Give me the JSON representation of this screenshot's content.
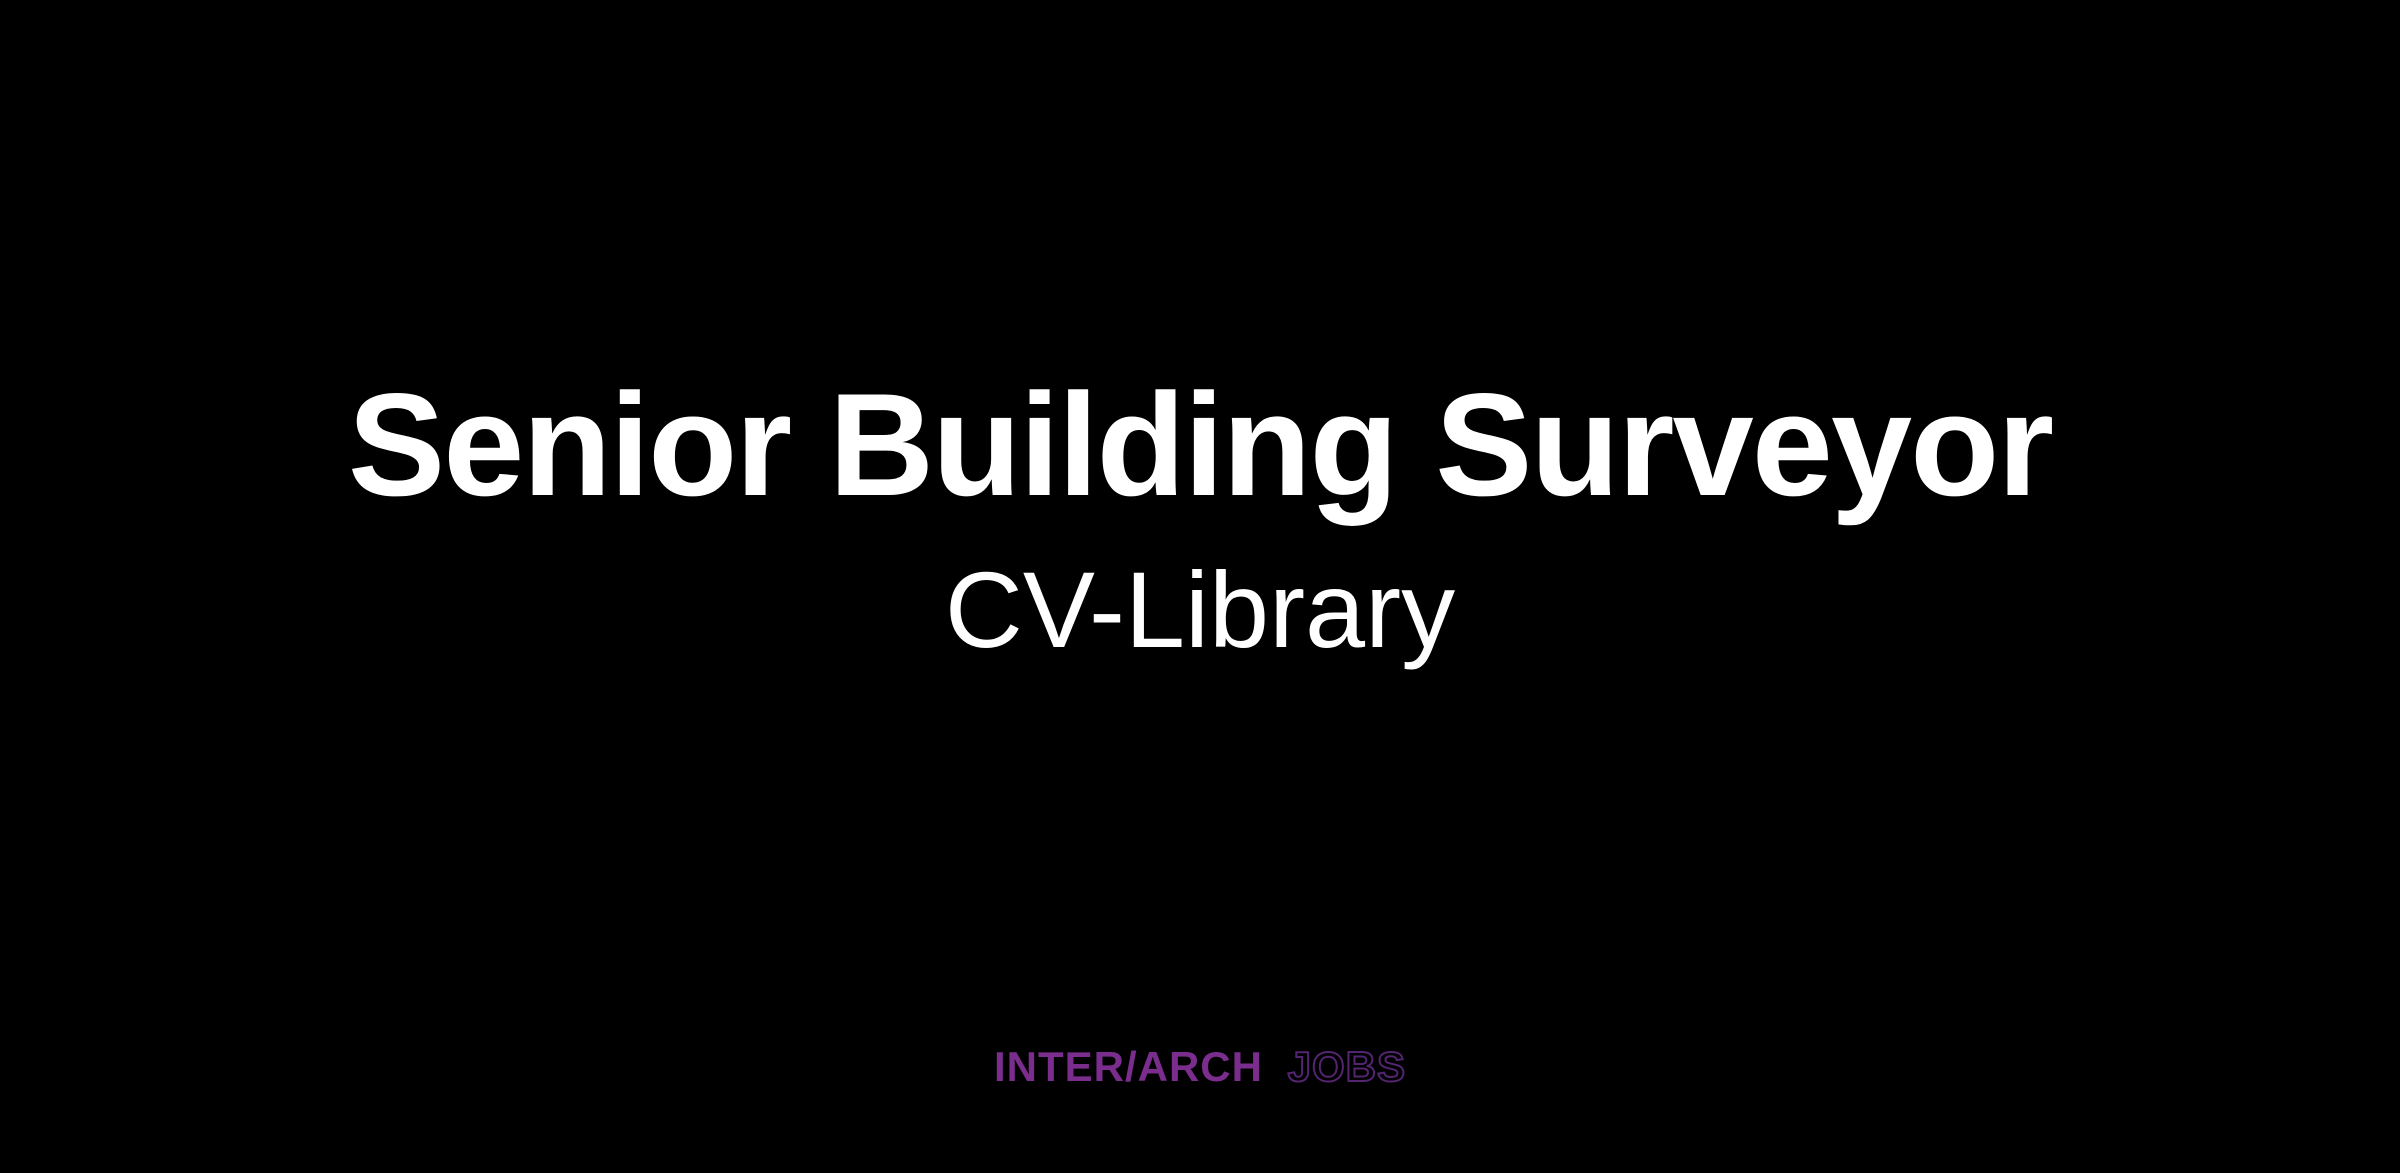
{
  "card": {
    "background_color": "#000000",
    "title": "Senior Building Surveyor",
    "title_color": "#ffffff",
    "subtitle": "CV-Library",
    "subtitle_color": "#ffffff",
    "logo": {
      "part_solid": "INTER/ARCH",
      "part_outline": "JOBS",
      "solid_color": "#7a2d8c",
      "outline_color": "#532470"
    }
  }
}
